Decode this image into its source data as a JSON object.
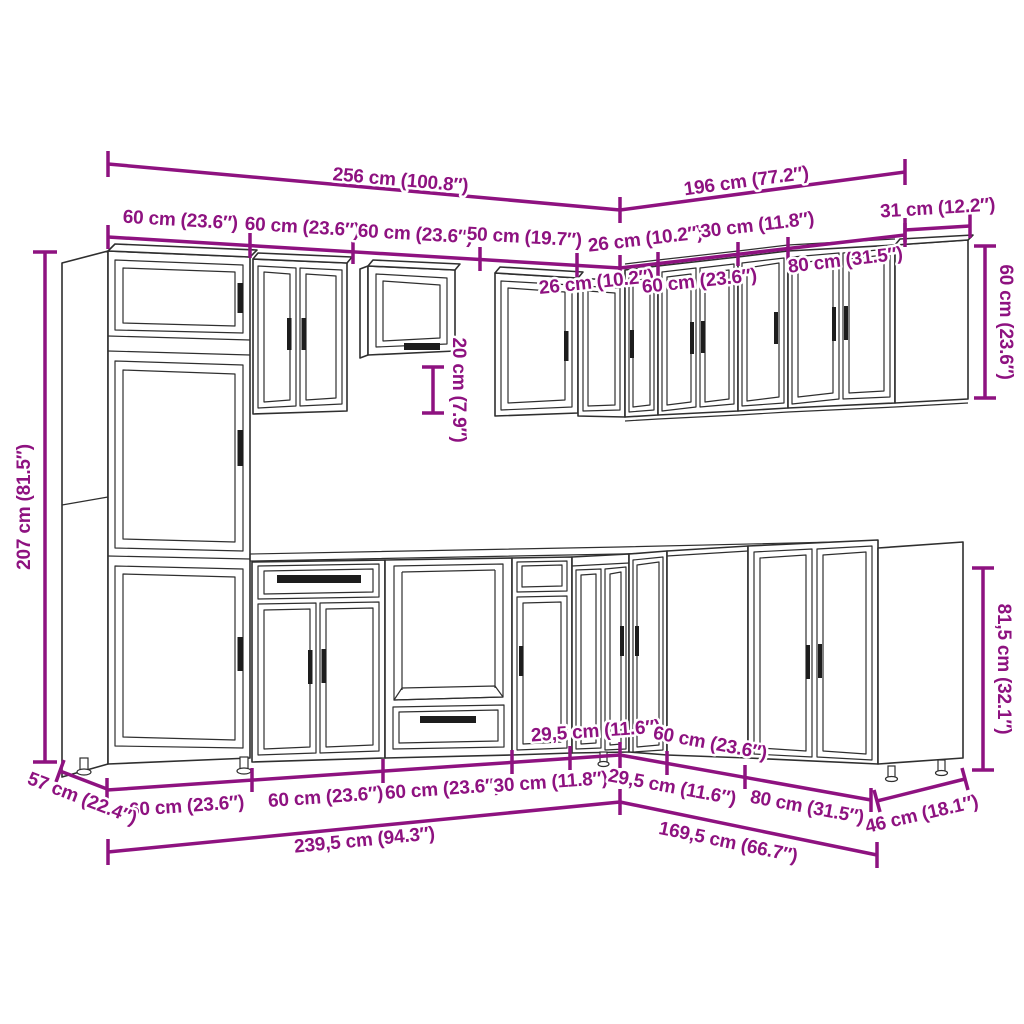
{
  "diagram": {
    "type": "kitchen-cabinet-set-dimensions",
    "colors": {
      "dimension": "#8E1280",
      "line_art": "#2F2F2F",
      "background": "#FFFFFF"
    },
    "top": {
      "total_left": "256 cm (100.8″)",
      "total_right": "196 cm (77.2″)",
      "right_end_width": "31 cm (12.2″)",
      "left_segments": {
        "s1": "60 cm (23.6″)",
        "s2": "60 cm (23.6″)",
        "s3": "60 cm (23.6″)",
        "s4": "50 cm (19.7″)"
      },
      "right_segments": {
        "s26": "26 cm (10.2″)",
        "s30": "30 cm (11.8″)",
        "s80": "80 cm (31.5″)",
        "c26": "26 cm (10.2″)",
        "c60": "60 cm (23.6″)"
      }
    },
    "heights": {
      "tall_left": "207 cm (81.5″)",
      "mid_gap": "20 cm (7.9″)",
      "wall_right": "60 cm (23.6″)",
      "base_right": "81,5 cm (32.1″)"
    },
    "bottom": {
      "depth_left": "57 cm (22.4″)",
      "depth_right": "46 cm (18.1″)",
      "left_segments": {
        "s1": "60 cm (23.6″)",
        "s2": "60 cm (23.6″)",
        "s3": "60 cm (23.6″)",
        "s4": "30 cm (11.8″)",
        "s5": "29,5 cm (11.6″)"
      },
      "right_segments": {
        "s1": "29,5 cm (11.6″)",
        "s2": "60 cm (23.6″)",
        "s3": "80 cm (31.5″)"
      },
      "total_left": "239,5 cm (94.3″)",
      "total_right": "169,5 cm (66.7″)"
    }
  }
}
